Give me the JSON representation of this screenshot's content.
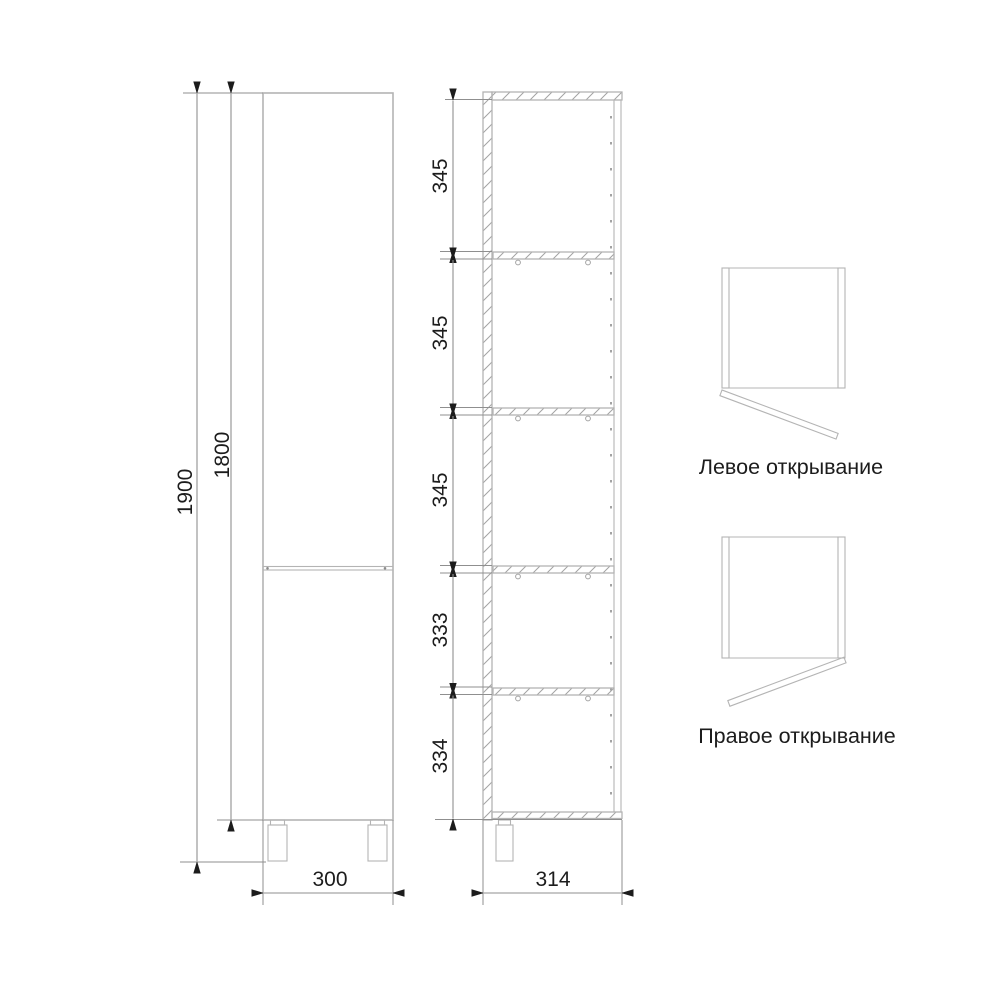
{
  "front_view": {
    "height_total": "1900",
    "height_body": "1800",
    "width": "300"
  },
  "section_view": {
    "spacings": [
      "345",
      "345",
      "345",
      "333",
      "334"
    ],
    "depth": "314"
  },
  "door_diagrams": {
    "left_label": "Левое открывание",
    "right_label": "Правое открывание"
  },
  "colors": {
    "furniture_line": "#b4b4b4",
    "hatch_line": "#a3a3a3",
    "dim_line": "#8f8f8f",
    "ink": "#1c1c1c",
    "background": "#ffffff"
  }
}
